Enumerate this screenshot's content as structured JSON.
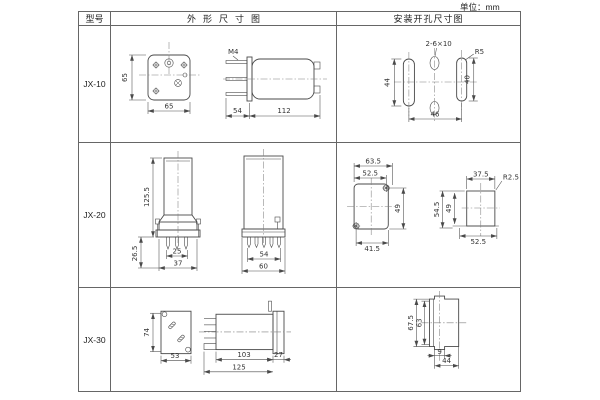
{
  "unit_label": "单位：mm",
  "colors": {
    "line": "#4a4a4a",
    "border": "#666666",
    "text": "#333333",
    "background": "#ffffff"
  },
  "header": {
    "model": "型号",
    "outline": "外形尺寸图",
    "mounting": "安装开孔尺寸图"
  },
  "rows": [
    {
      "model": "JX-10",
      "outline": {
        "plate_h": "65",
        "plate_w": "65",
        "thread": "M4",
        "stud": "54",
        "body": "112"
      },
      "mounting": {
        "holes": "2-6×10",
        "radius": "R5",
        "left_h": "44",
        "right_h": "40",
        "span": "46"
      }
    },
    {
      "model": "JX-20",
      "outline": {
        "height": "125.5",
        "pin_h": "26.5",
        "pins_w": "25",
        "base_w": "37",
        "pins2_w": "54",
        "base2_w": "60"
      },
      "mounting": {
        "outer_w": "63.5",
        "inner_w": "52.5",
        "side_h": "49",
        "bottom_w": "41.5",
        "top_w": "37.5",
        "radius": "R2.5",
        "outer_h": "54.5",
        "inner_h": "49",
        "bottom_w2": "52.5"
      }
    },
    {
      "model": "JX-30",
      "outline": {
        "plate_h": "74",
        "plate_w": "53",
        "body": "103",
        "flange": "27",
        "total": "125"
      },
      "mounting": {
        "outer_h": "67.5",
        "inner_h": "63",
        "notch": "9",
        "width": "44"
      }
    }
  ]
}
